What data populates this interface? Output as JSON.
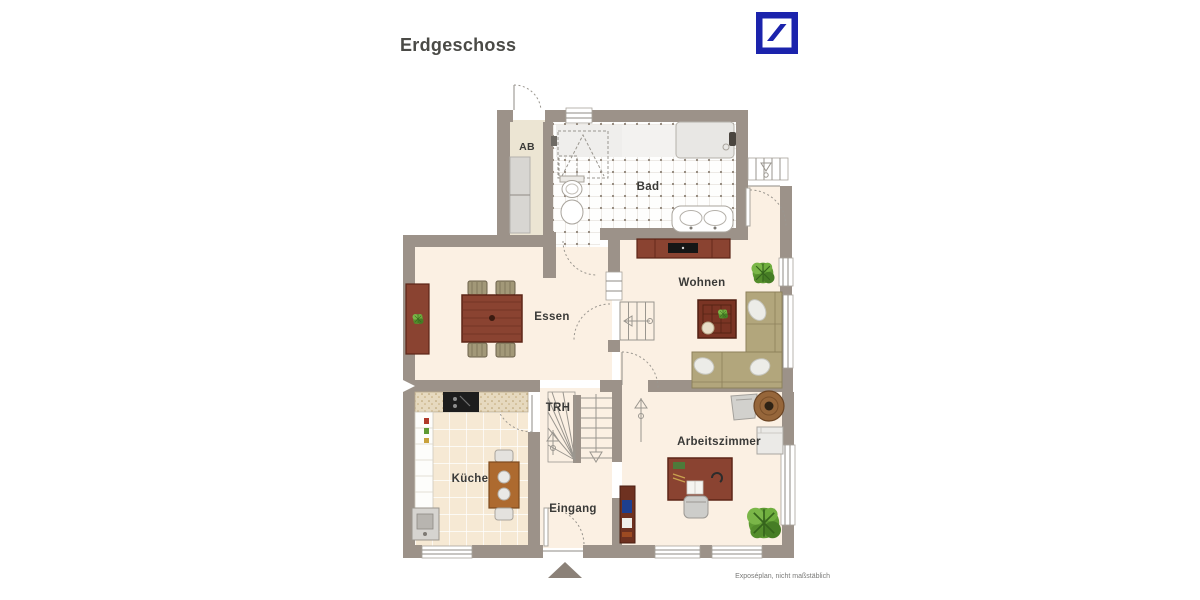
{
  "header": {
    "title": "Erdgeschoss"
  },
  "logo": {
    "color": "#1b23ac"
  },
  "rooms": {
    "ab": "AB",
    "bad": "Bad",
    "essen": "Essen",
    "wohnen": "Wohnen",
    "kueche": "Küche",
    "trh": "TRH",
    "eingang": "Eingang",
    "arbeitszimmer": "Arbeitszimmer"
  },
  "footer": {
    "note": "Exposéplan, nicht maßstäblich"
  },
  "colors": {
    "wall": "#9c9289",
    "floor": "#fbf0e3",
    "kitchen_floor": "#f6e9d4",
    "bath_tile": "#fefefd",
    "wood": "#8a4331",
    "wood_dark": "#5c2517",
    "sofa": "#b2a67c",
    "plant": "#5e9a33",
    "logo_blue": "#1b23ac"
  }
}
